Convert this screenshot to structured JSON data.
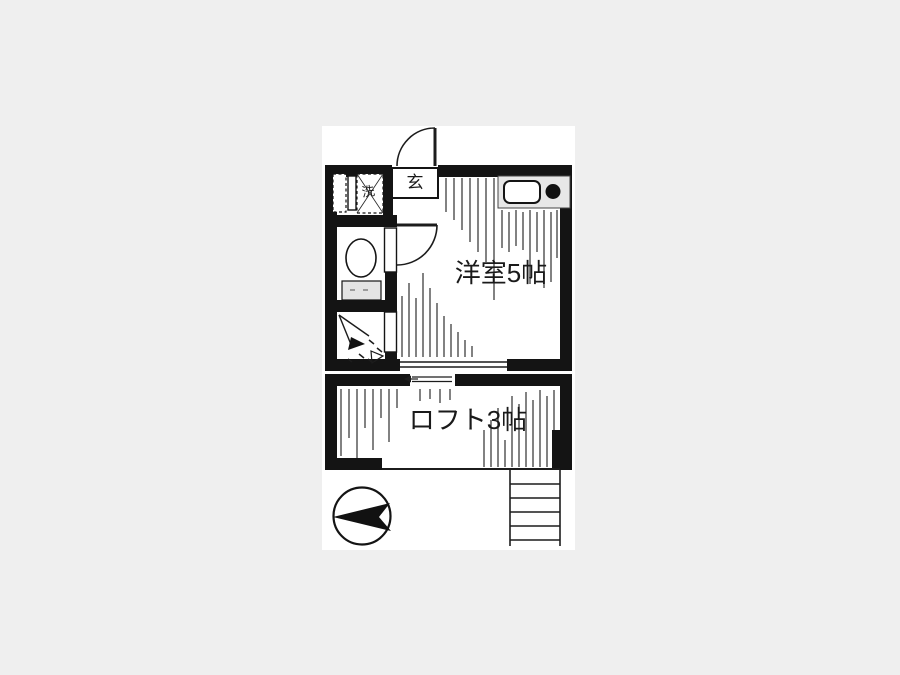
{
  "colors": {
    "background": "#efefef",
    "paper": "#ffffff",
    "ink": "#141414",
    "counter_fill": "#e7e7e7",
    "tank_fill": "#e4e4e4"
  },
  "labels": {
    "main_room": "洋室5帖",
    "loft": "ロフト3帖",
    "entrance": "玄",
    "laundry": "洗"
  },
  "rooms": [
    {
      "name": "western-room",
      "label": "洋室5帖",
      "size_tatami": 5
    },
    {
      "name": "loft",
      "label": "ロフト3帖",
      "size_tatami": 3
    },
    {
      "name": "entrance",
      "label": "玄"
    },
    {
      "name": "laundry-space",
      "label": "洗"
    }
  ],
  "icons": [
    "north-arrow-icon",
    "stairs-icon",
    "toilet-icon",
    "shower-icon",
    "kitchen-counter-icon",
    "sink-icon",
    "burner-icon",
    "washing-machine-icon",
    "entrance-door-icon",
    "room-door-icon",
    "toilet-door-icon",
    "shower-door-icon",
    "window-icon",
    "loft-ladder-icon"
  ]
}
